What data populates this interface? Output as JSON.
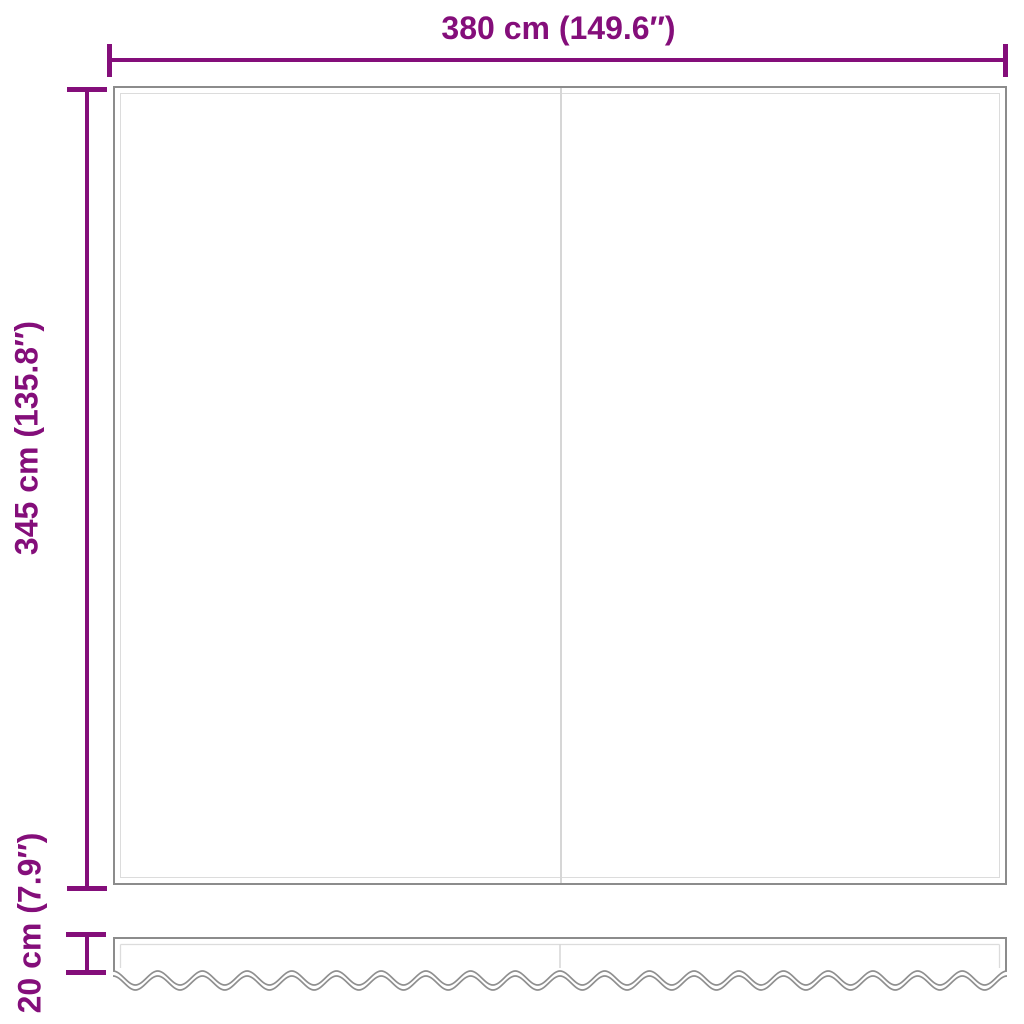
{
  "colors": {
    "dimension": "#840e7a",
    "outline": "#8c8c8c",
    "inner_line": "#dcdcdc",
    "seam": "#d6d6d6",
    "background": "#ffffff"
  },
  "diagram": {
    "type": "product-dimension-drawing",
    "subject": "awning fabric with wavy valance, front panel with center seam",
    "width_label": "380 cm (149.6″)",
    "height_label": "345 cm (135.8″)",
    "valance_height_label": "20 cm (7.9″)"
  }
}
